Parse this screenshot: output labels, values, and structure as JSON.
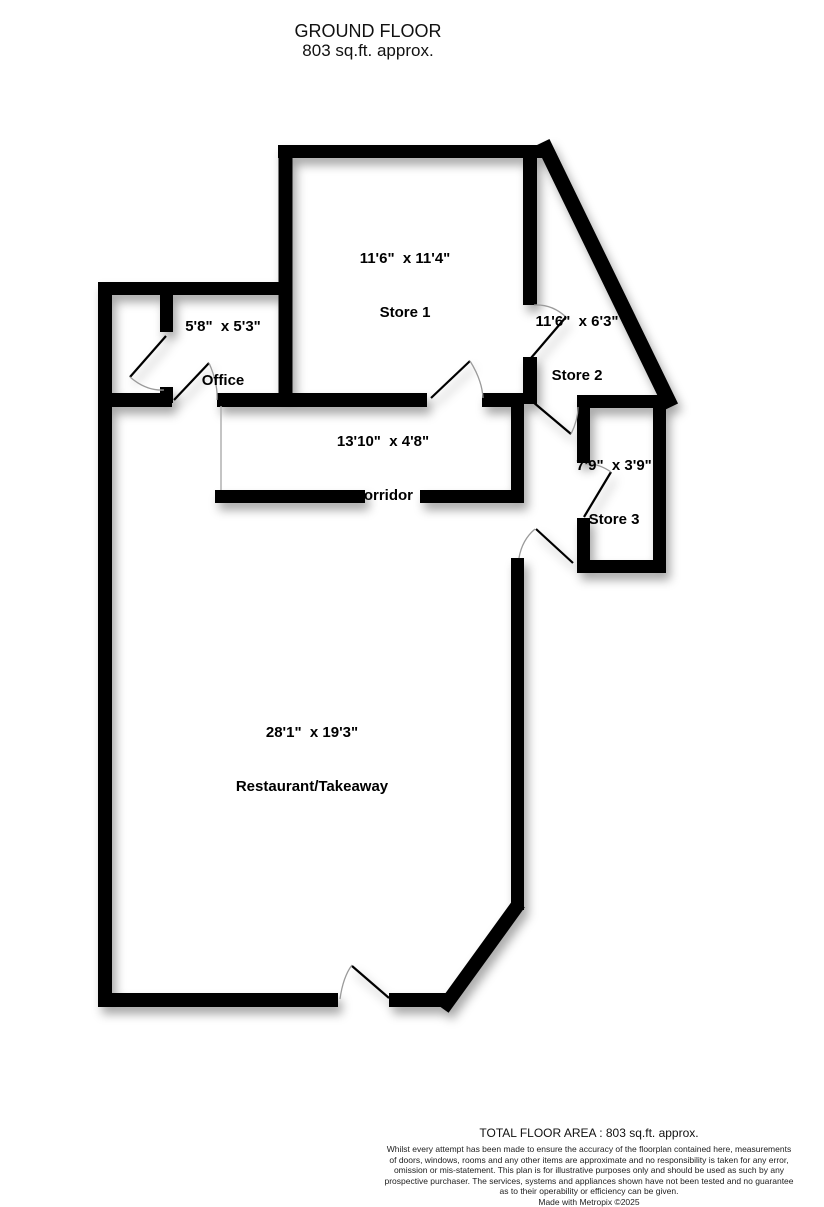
{
  "header": {
    "title": "GROUND FLOOR",
    "subtitle": "803 sq.ft. approx."
  },
  "rooms": [
    {
      "id": "store1",
      "dims": "11'6\"  x 11'4\"",
      "name": "Store 1"
    },
    {
      "id": "store2",
      "dims": "11'6\"  x 6'3\"",
      "name": "Store 2"
    },
    {
      "id": "office",
      "dims": "5'8\"  x 5'3\"",
      "name": "Office"
    },
    {
      "id": "corridor",
      "dims": "13'10\"  x 4'8\"",
      "name": "Corridor"
    },
    {
      "id": "store3",
      "dims": "7'9\"  x 3'9\"",
      "name": "Store 3"
    },
    {
      "id": "restaurant",
      "dims": "28'1\"  x 19'3\"",
      "name": "Restaurant/Takeaway"
    }
  ],
  "footer": {
    "total_area": "TOTAL FLOOR AREA : 803 sq.ft. approx.",
    "disclaimer_lines": [
      "Whilst every attempt has been made to ensure the accuracy of the floorplan contained here, measurements",
      "of doors, windows, rooms and any other items are approximate and no responsibility is taken for any error,",
      "omission or mis-statement. This plan is for illustrative purposes only and should be used as such by any",
      "prospective purchaser. The services, systems and appliances shown have not been tested and no guarantee",
      "as to their operability or efficiency can be given."
    ],
    "made_with": "Made with Metropix ©2025"
  },
  "colors": {
    "wall": "#000000",
    "background": "#ffffff",
    "door_arc": "#9a9a9a",
    "shadow": "rgba(0,0,0,0.35)"
  }
}
